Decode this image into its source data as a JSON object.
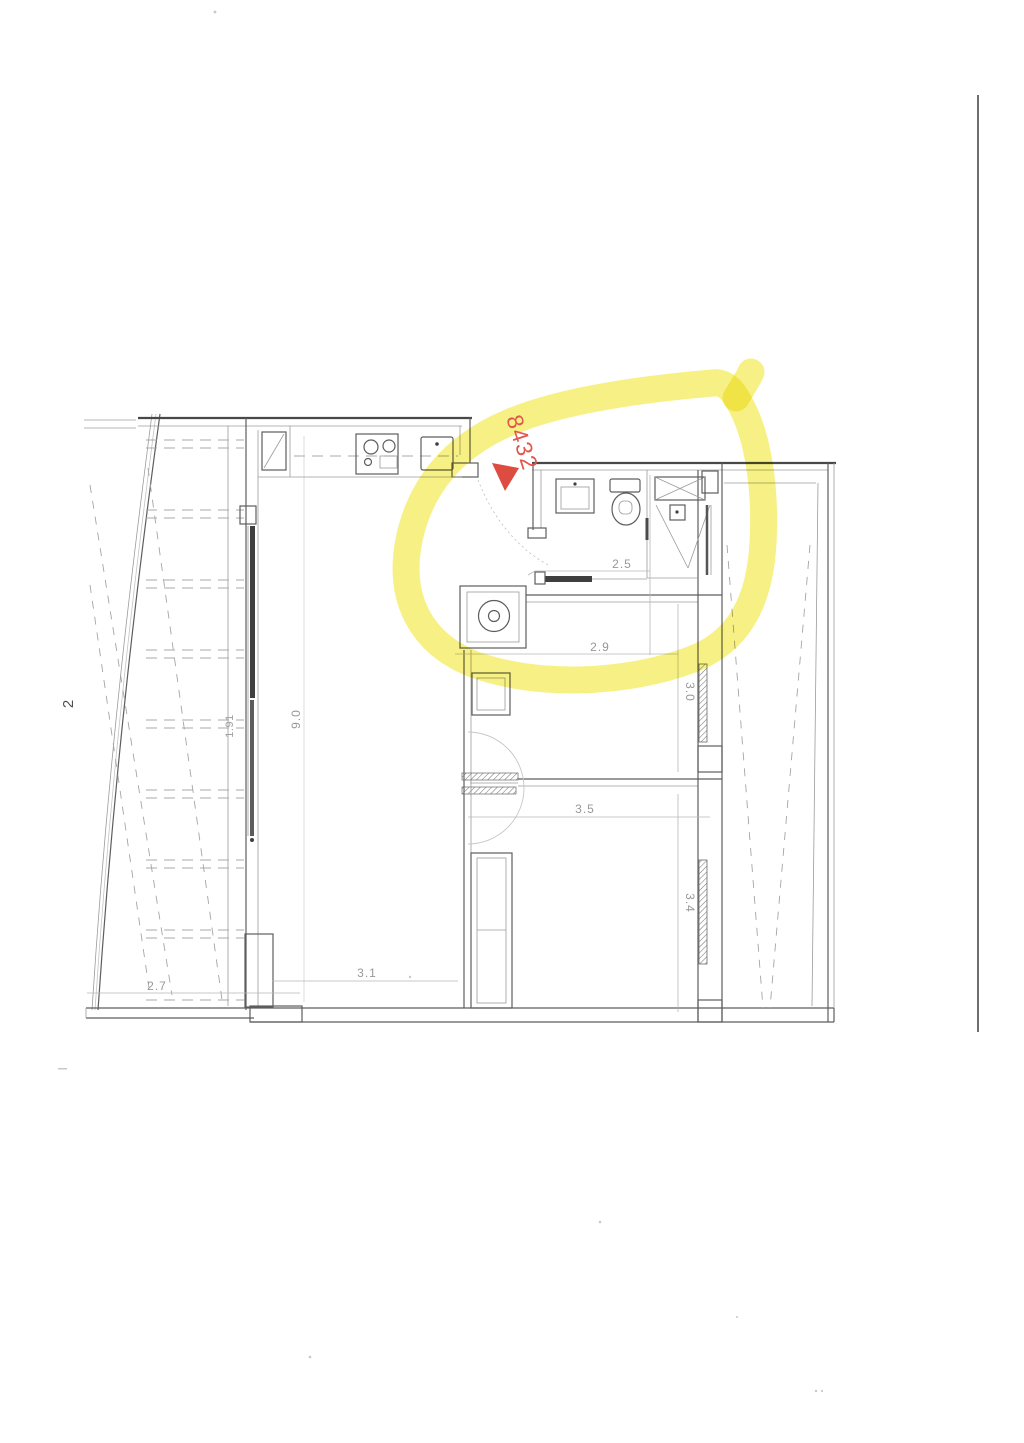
{
  "page": {
    "number": "2"
  },
  "annotation": {
    "code": "8432",
    "code_color": "#e2574c",
    "marker_color": "#dd4b41",
    "highlight_color": "#f2e93a"
  },
  "dimensions": {
    "bathroom_width": "2.5",
    "bedroom1_width": "2.9",
    "bedroom1_depth": "3.0",
    "bedroom2_width": "3.5",
    "bedroom2_depth": "3.4",
    "living_width": "3.1",
    "terrace_width": "2.7",
    "living_length": "9.0",
    "balcony_depth": "1.91"
  },
  "fixtures": {
    "kitchen": [
      "tall-cabinet-icon",
      "stove-icon",
      "kitchen-sink-icon"
    ],
    "bathroom": [
      "washbasin-icon",
      "toilet-icon",
      "shower-icon",
      "shelf-icon"
    ],
    "laundry": [
      "washing-machine-icon"
    ]
  },
  "colors": {
    "plan_line": "#5d5d5d",
    "dimension_text": "#989898",
    "scan_edge": "#4a4a4a"
  }
}
